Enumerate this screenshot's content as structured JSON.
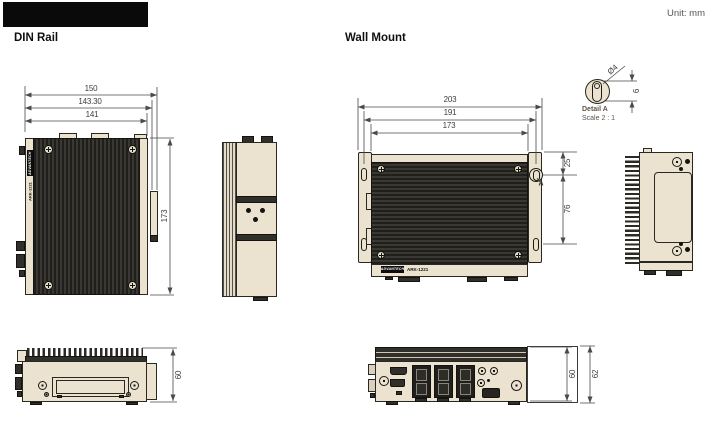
{
  "header": {
    "unit_label": "Unit: mm"
  },
  "din_rail": {
    "title": "DIN Rail",
    "top_view": {
      "width_outer": "150",
      "width_mid": "143.30",
      "width_inner": "141",
      "height": "173"
    },
    "front_view": {
      "height": "60"
    },
    "device_label": {
      "brand": "ADVANTECH",
      "model": "ARK-1221"
    }
  },
  "wall_mount": {
    "title": "Wall Mount",
    "top_view": {
      "width_outer": "203",
      "width_mid": "191",
      "width_inner": "173",
      "offset_top": "25",
      "slot_spacing": "76",
      "detail_marker": "A"
    },
    "front_view": {
      "height_body": "60",
      "height_total": "62"
    },
    "device_label": {
      "brand": "ADVANTECH",
      "model": "ARK-1221"
    }
  },
  "detail_a": {
    "title": "Detail A",
    "scale": "Scale 2 : 1",
    "diameter": "Ø4",
    "slot_height": "6"
  },
  "colors": {
    "body_fill": "#ebe3d0",
    "heatsink": "#2b2a26",
    "outline": "#2a2822",
    "dimension": "#4a4a4a"
  }
}
